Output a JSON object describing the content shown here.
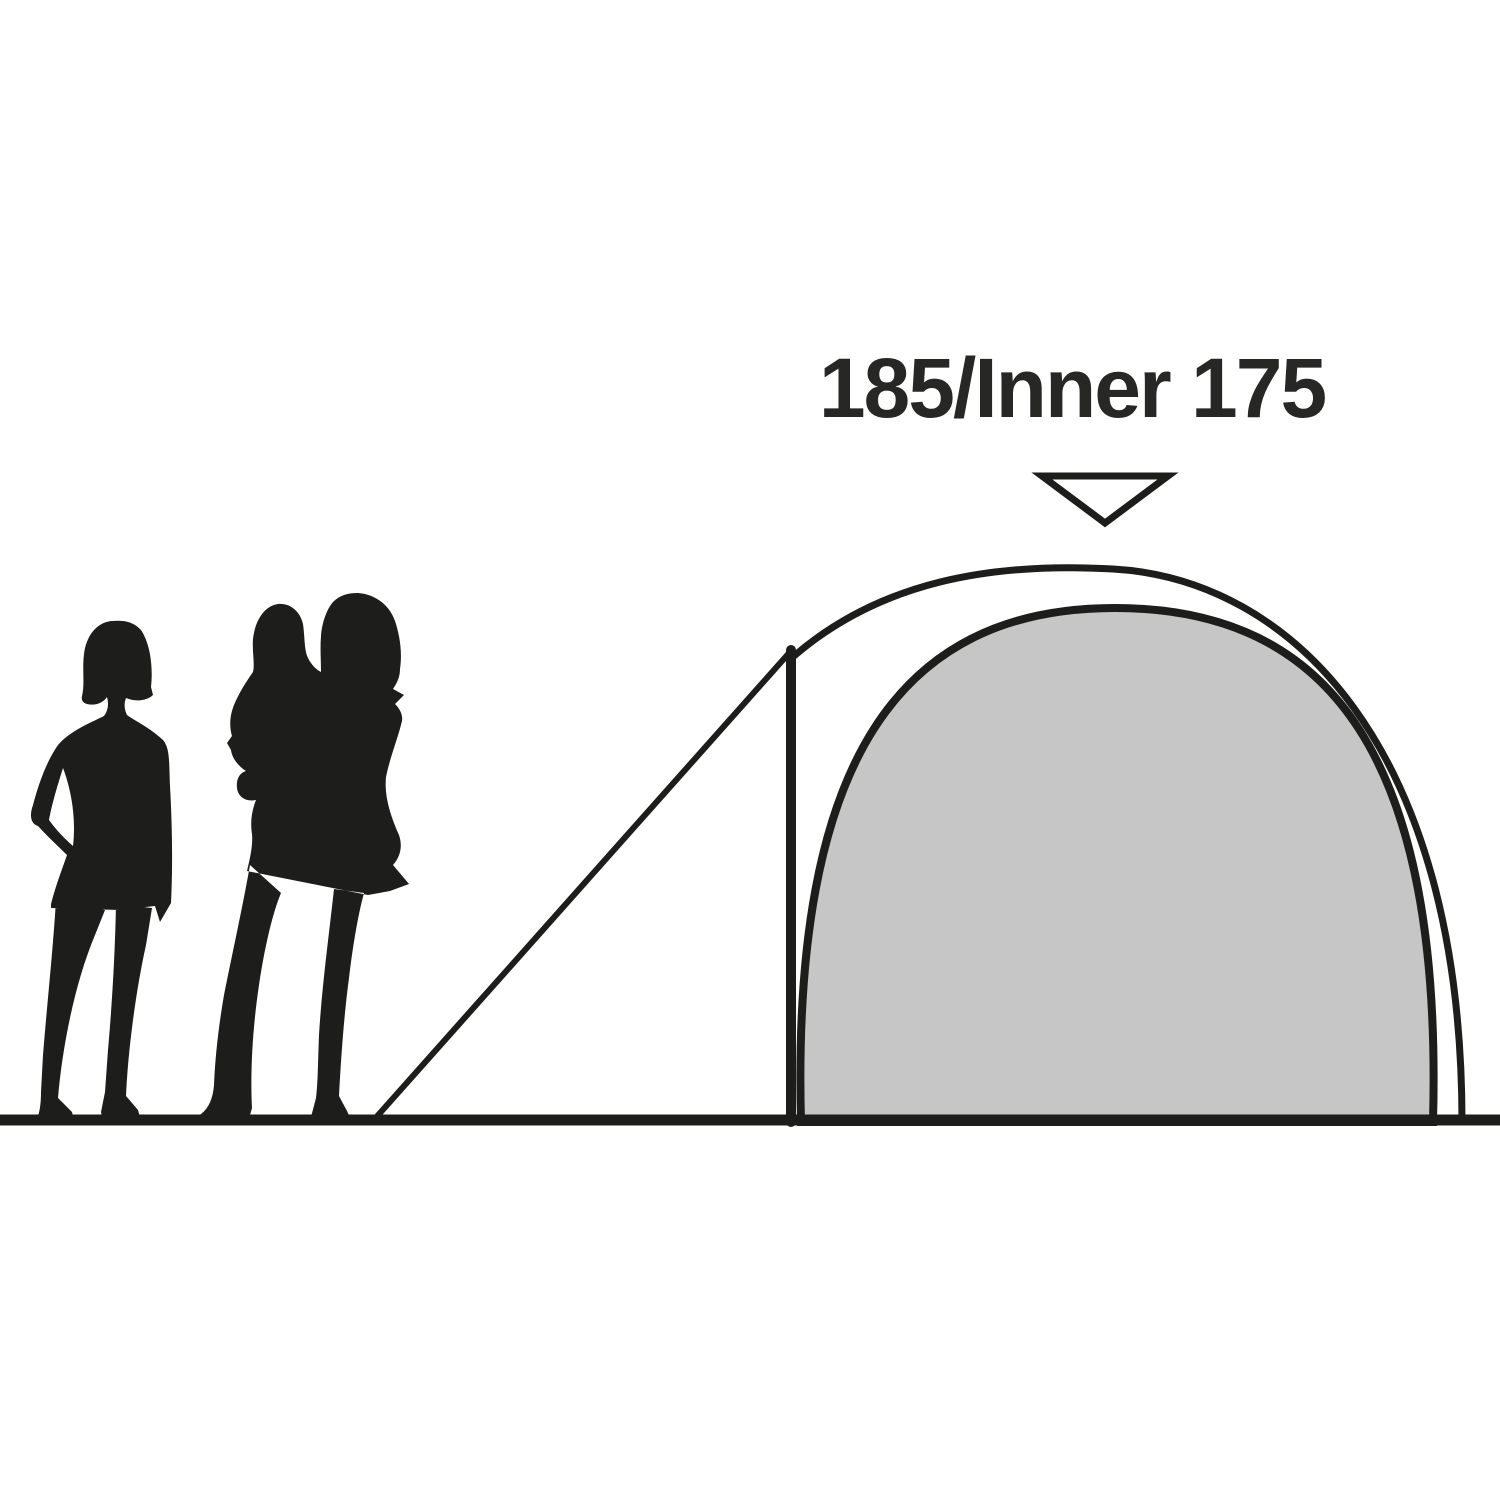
{
  "label": {
    "text": "185/Inner 175"
  },
  "measurements": {
    "outer_height": 185,
    "inner_height": 175
  },
  "colors": {
    "background": "#ffffff",
    "line": "#1d1d1b",
    "silhouette": "#1d1d1b",
    "inner_tent_fill": "#c6c6c6",
    "pointer_fill": "#ffffff",
    "label_text": "#272726"
  },
  "icons": {
    "pointer": "triangle-down"
  },
  "figures": [
    {
      "name": "adult-silhouette"
    },
    {
      "name": "adult-carrying-child-silhouette"
    }
  ]
}
